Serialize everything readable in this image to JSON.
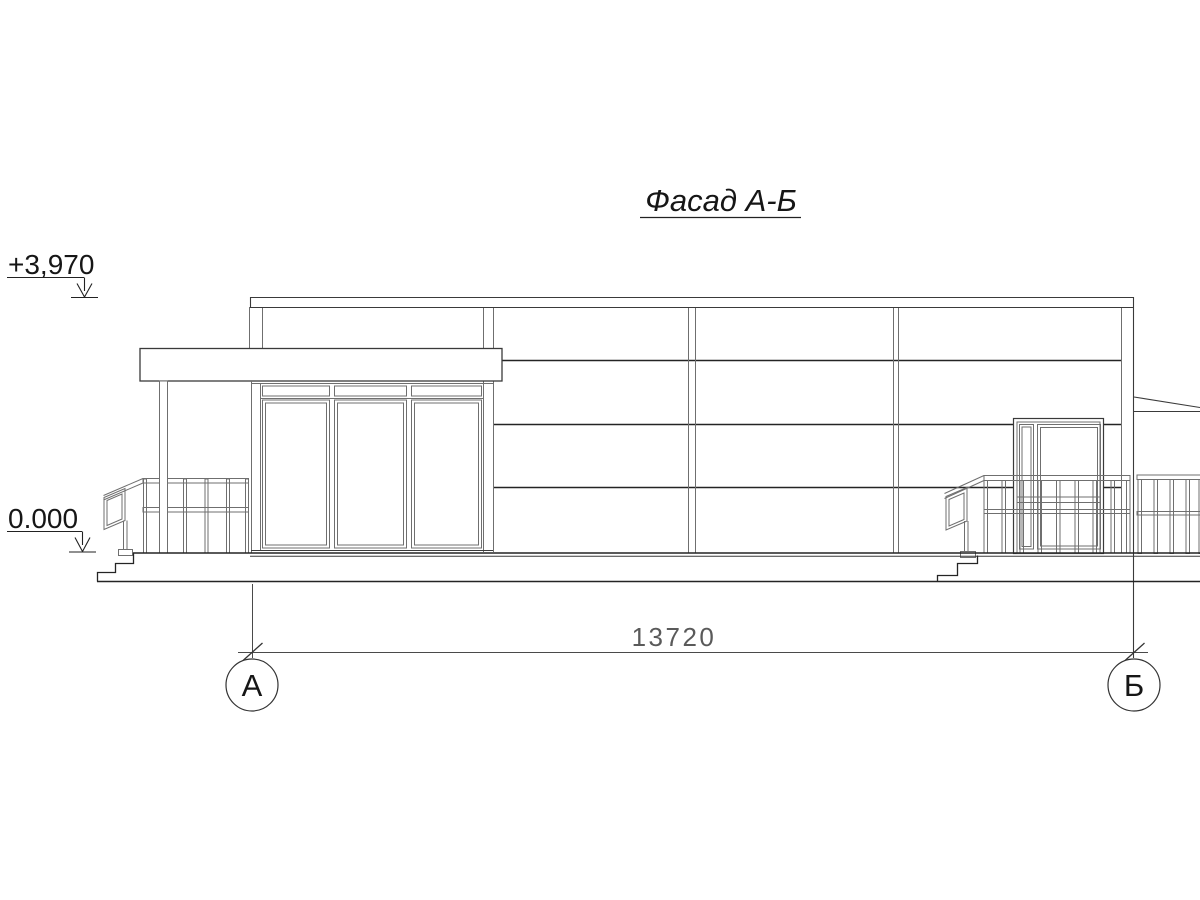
{
  "drawing": {
    "title": "Фасад А-Б",
    "elevation_marks": {
      "upper": "+3,970",
      "lower": "0.000"
    },
    "dimension": {
      "value": "13720"
    },
    "axes": {
      "left": "А",
      "right": "Б"
    },
    "colors": {
      "line_heavy": "#242424",
      "line_mid": "#3a3a3a",
      "line_light": "#6f6f6f",
      "dim_text": "#5a5a5a"
    }
  }
}
